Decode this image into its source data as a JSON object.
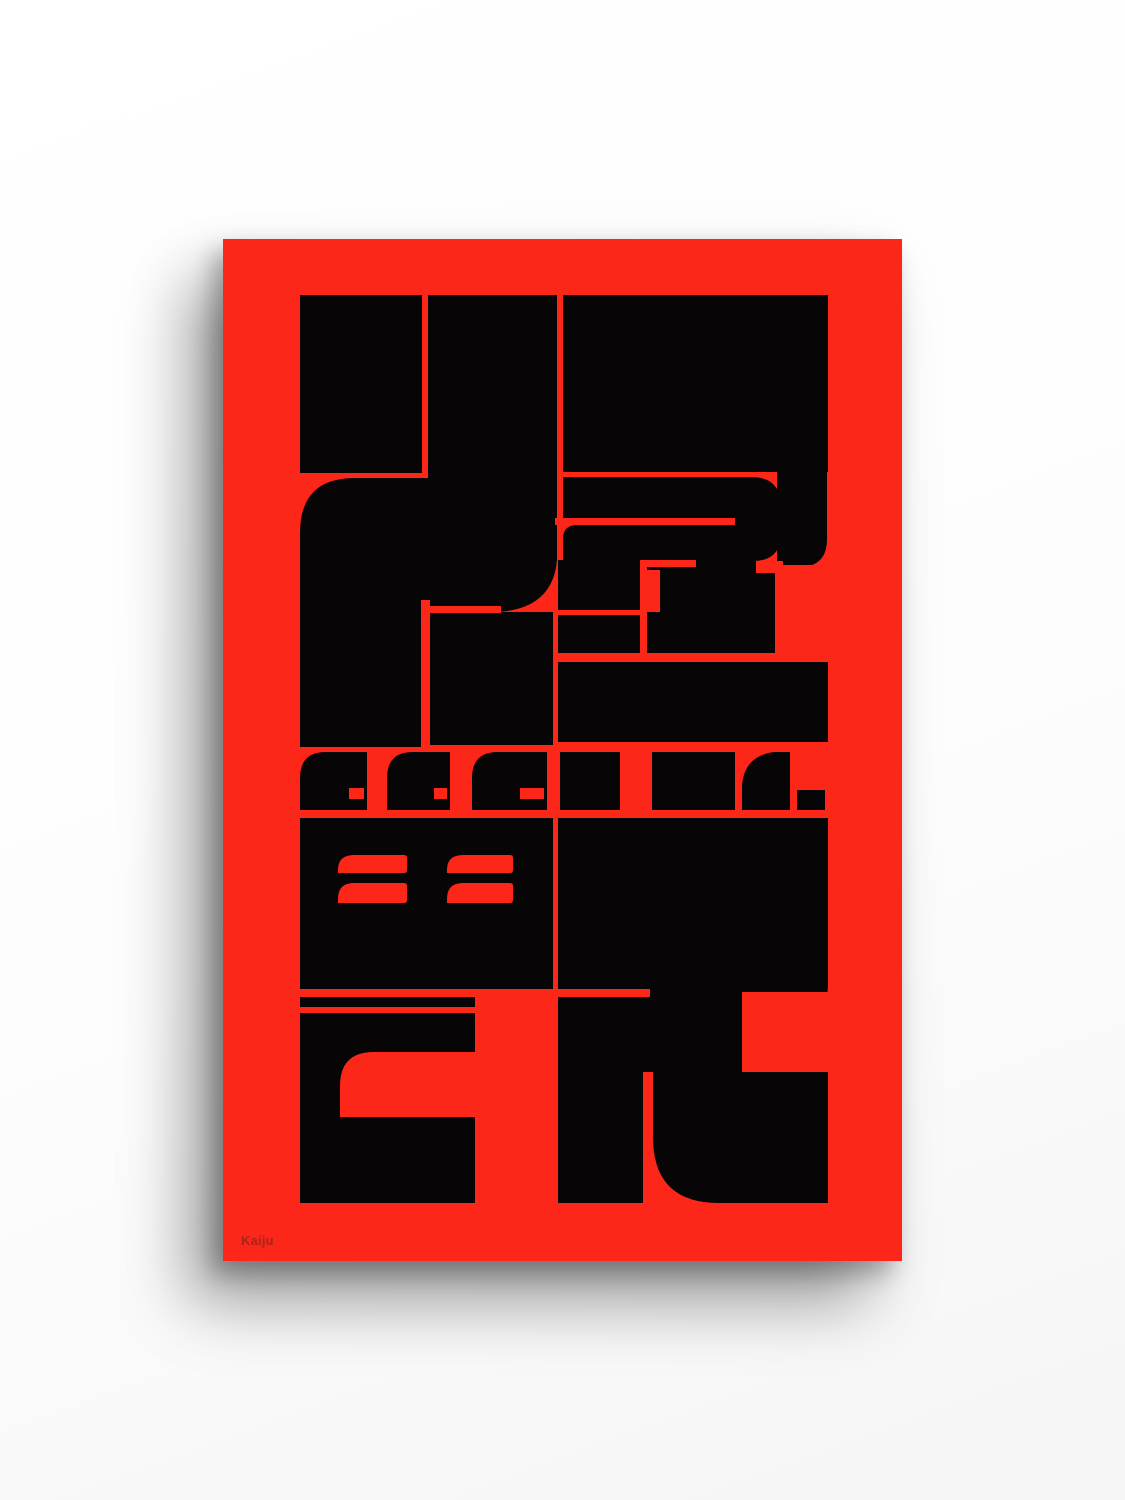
{
  "page": {
    "background_color": "#fdfdfd"
  },
  "poster": {
    "caption": "Kaiju",
    "colors": {
      "poster_red": "#fc2718",
      "ink_black": "#070505",
      "caption_text": "#a8241c"
    }
  }
}
